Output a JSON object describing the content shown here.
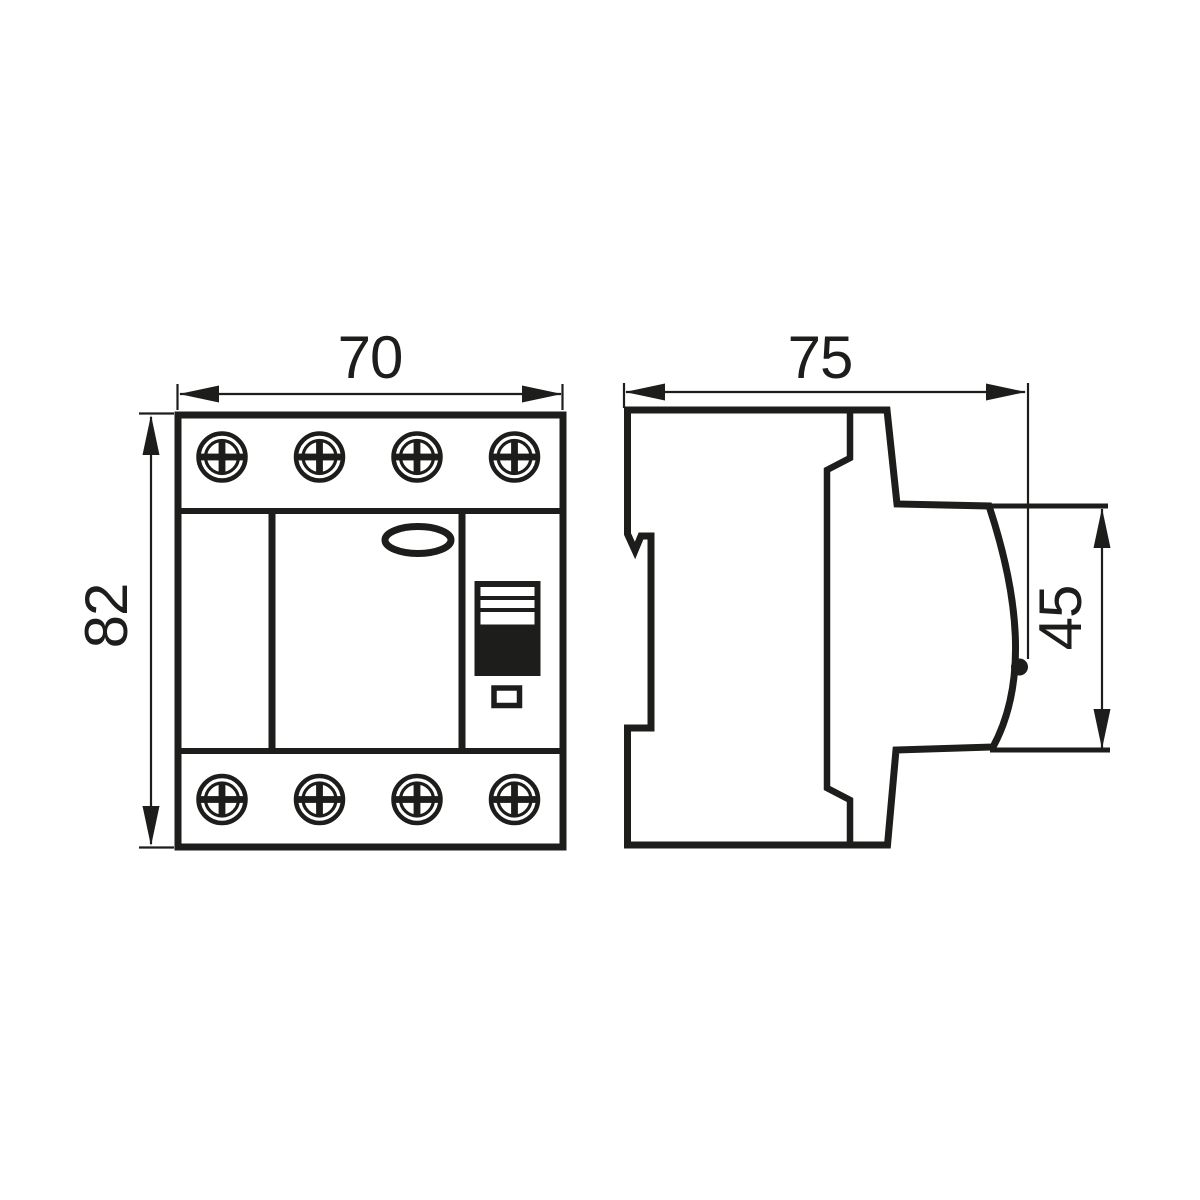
{
  "dimensions": {
    "front_width_mm": "70",
    "front_height_mm": "82",
    "side_depth_mm": "75",
    "front_panel_height_mm": "45"
  },
  "colors": {
    "line": "#1d1d1b",
    "background": "#ffffff"
  },
  "icons": {
    "terminal-screw-icon": "circle-with-phillips-cross",
    "toggle-switch-icon": "striped-rect-with-black-lever",
    "indicator-window-icon": "small-outlined-rect",
    "label-window-icon": "ellipse-outline",
    "lever-tip-dot-icon": "filled-circle",
    "dimension-arrow-icon": "filled-triangle"
  }
}
